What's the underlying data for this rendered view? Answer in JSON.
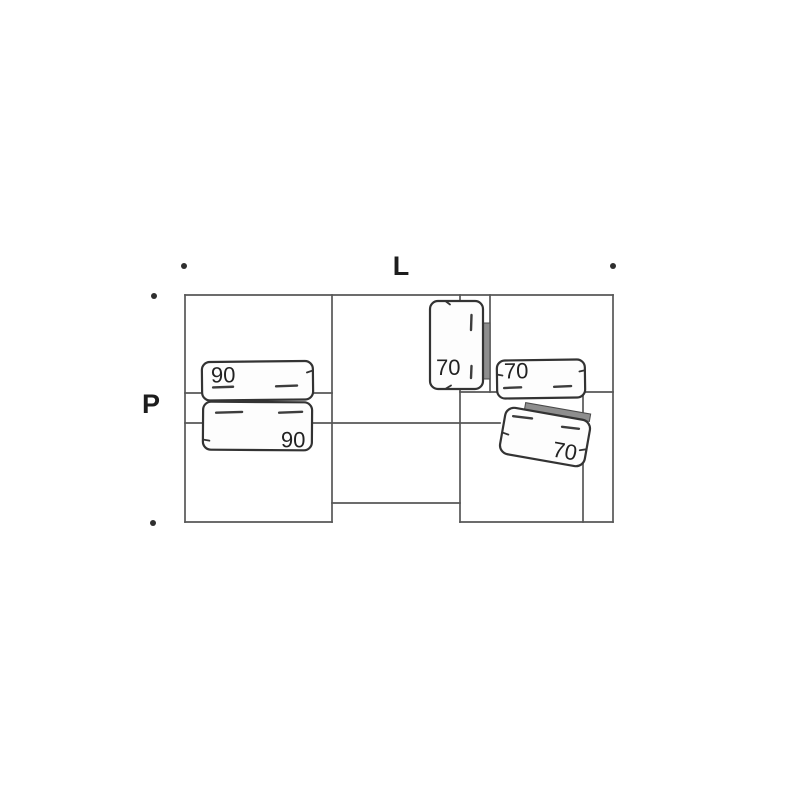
{
  "diagram": {
    "type": "furniture-plan",
    "width_label": "L",
    "depth_label": "P",
    "cushions": [
      {
        "name": "cushion-left-top",
        "label": "90"
      },
      {
        "name": "cushion-left-bottom",
        "label": "90"
      },
      {
        "name": "cushion-middle-vertical",
        "label": "70"
      },
      {
        "name": "cushion-right-horizontal",
        "label": "70"
      },
      {
        "name": "cushion-right-tilted",
        "label": "70"
      }
    ],
    "dimension_dots": 4,
    "colors": {
      "background": "#ffffff",
      "frame_line": "#575757",
      "cushion_line": "#333333",
      "shade": "#8e8e8e",
      "text": "#1d1d1d"
    }
  }
}
